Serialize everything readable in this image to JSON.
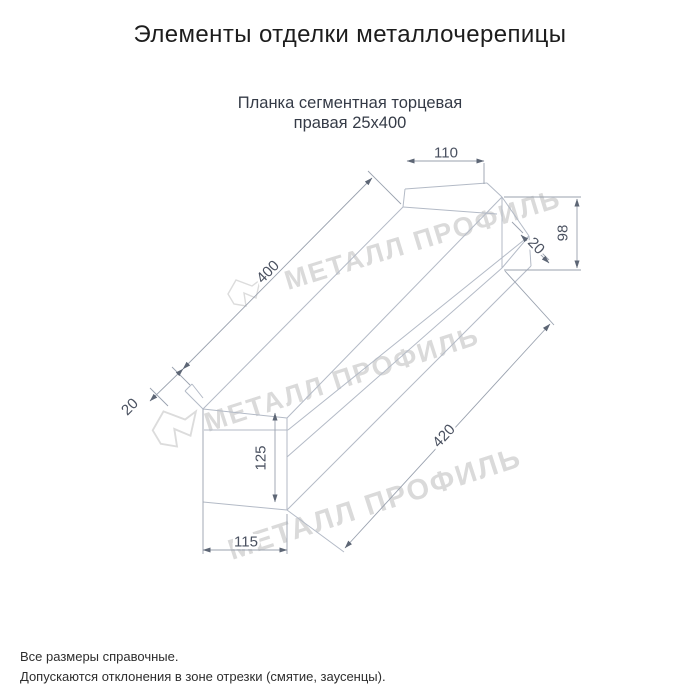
{
  "page": {
    "title": "Элементы отделки металлочерепицы"
  },
  "product": {
    "subtitle_line1": "Планка сегментная торцевая",
    "subtitle_line2": "правая 25х400"
  },
  "drawing": {
    "type": "axonometric technical drawing of right segmental end trim strip",
    "dimensions": {
      "top_flange_width": "110",
      "end_cap_height": "98",
      "end_cap_fold": "20",
      "top_length": "400",
      "left_fold": "20",
      "face_height": "125",
      "bottom_width": "115",
      "bottom_length": "420"
    },
    "watermark": {
      "text": "МЕТАЛЛ ПРОФИЛЬ",
      "color": "#dadada"
    },
    "line_color": "#b3bac6",
    "dim_line_color": "#99a1ae",
    "dim_text_color": "#4a5160"
  },
  "notes": {
    "line1": "Все размеры справочные.",
    "line2": "Допускаются отклонения в зоне отрезки (смятие, заусенцы)."
  }
}
